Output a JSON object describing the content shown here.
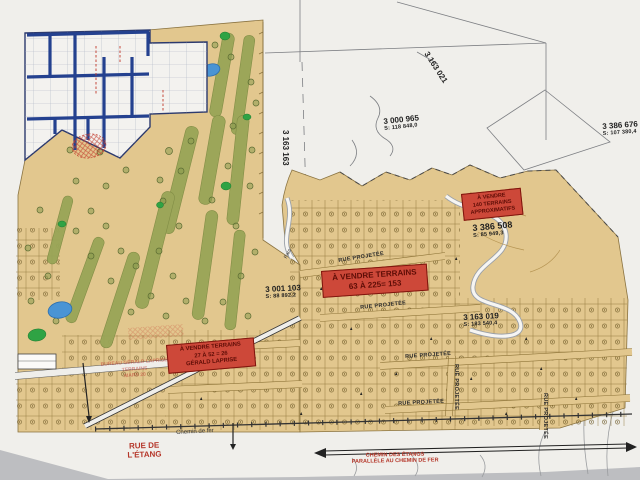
{
  "colors": {
    "sale_sign_red": "#cd4839",
    "land_tan": "#e2c78e",
    "fairway_green": "#99a557",
    "putting_green": "#2fa344",
    "water_blue": "#4a94d4",
    "plan_street_blue": "#24418f",
    "label_red": "#b5372a"
  },
  "lots": [
    {
      "number": "3 163 021"
    },
    {
      "number": "3 000 965",
      "area": "S: 118 848,0"
    },
    {
      "number": "3 386 676",
      "area": "S: 107 380,4"
    },
    {
      "number": "3 163 163"
    },
    {
      "number": "3 386 508",
      "area": "S: 85 949,3"
    },
    {
      "number": "3 001 103",
      "area": "S: 88 892,2"
    },
    {
      "number": "3 163 019",
      "area": "S: 183 540,4"
    }
  ],
  "signs": [
    {
      "lines": [
        "À VENDRE",
        "140 TERRAINS",
        "APPROXIMATIFS"
      ]
    },
    {
      "lines": [
        "À VENDRE TERRAINS",
        "63 À 225= 153"
      ]
    },
    {
      "lines": [
        "À VENDRE TERRAINS",
        "27 À 52 = 26",
        "GÉRALD LAPRISE"
      ]
    }
  ],
  "streets": {
    "projected": "RUE PROJETÉE"
  },
  "labels": {
    "parc": "Parc",
    "chemin_de_fer": "Chemin de fer",
    "rue_etang": [
      "RUE DE",
      "L'ÉTANG"
    ],
    "chemin_etangs": [
      "CHEMIN DES ÉTANGS",
      "PARALLÈLE AU CHEMIN DE FER"
    ],
    "stamp": [
      "BUREAU GÉRALD LAPRISE",
      "TERRAINS",
      "MARS 20"
    ]
  }
}
